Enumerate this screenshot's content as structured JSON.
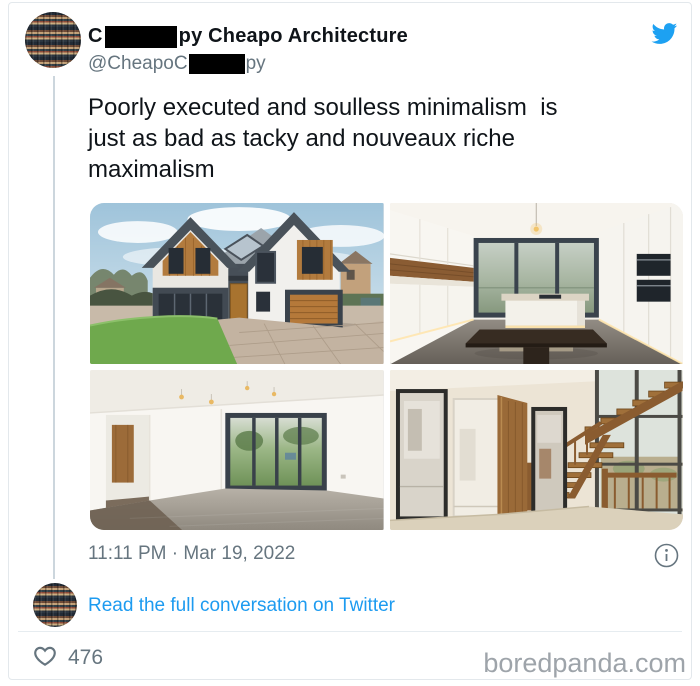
{
  "header": {
    "author_name_prefix": "C",
    "author_name_suffix": "py Cheapo Architecture",
    "handle_prefix": "@CheapoC",
    "handle_suffix": "py"
  },
  "tweet": {
    "text_lines": [
      "Poorly executed and soulless minimalism  is",
      "just as bad as tacky and nouveaux riche",
      "maximalism"
    ],
    "timestamp": "11:11 PM · Mar 19, 2022",
    "photos": [
      {
        "label": "modern house exterior with gabled roofs and wood cladding"
      },
      {
        "label": "minimalist white kitchen with island and dark table"
      },
      {
        "label": "empty living room with grey carpet and sliding glass doors"
      },
      {
        "label": "hallway with open wooden staircase and tall windows"
      }
    ]
  },
  "conversation": {
    "link_label": "Read the full conversation on Twitter"
  },
  "footer": {
    "like_count": "476",
    "watermark": "boredpanda.com"
  },
  "icons": {
    "header_icon": "twitter-bird",
    "meta_icon": "info-circle",
    "like_icon": "heart-outline"
  },
  "colors": {
    "twitter_blue": "#1da1f2",
    "link_blue": "#1d9bf0",
    "text_primary": "#0f1419",
    "text_secondary": "#66757f",
    "watermark_gray": "#9ea4aa",
    "thread_line": "#ccd6dd"
  }
}
